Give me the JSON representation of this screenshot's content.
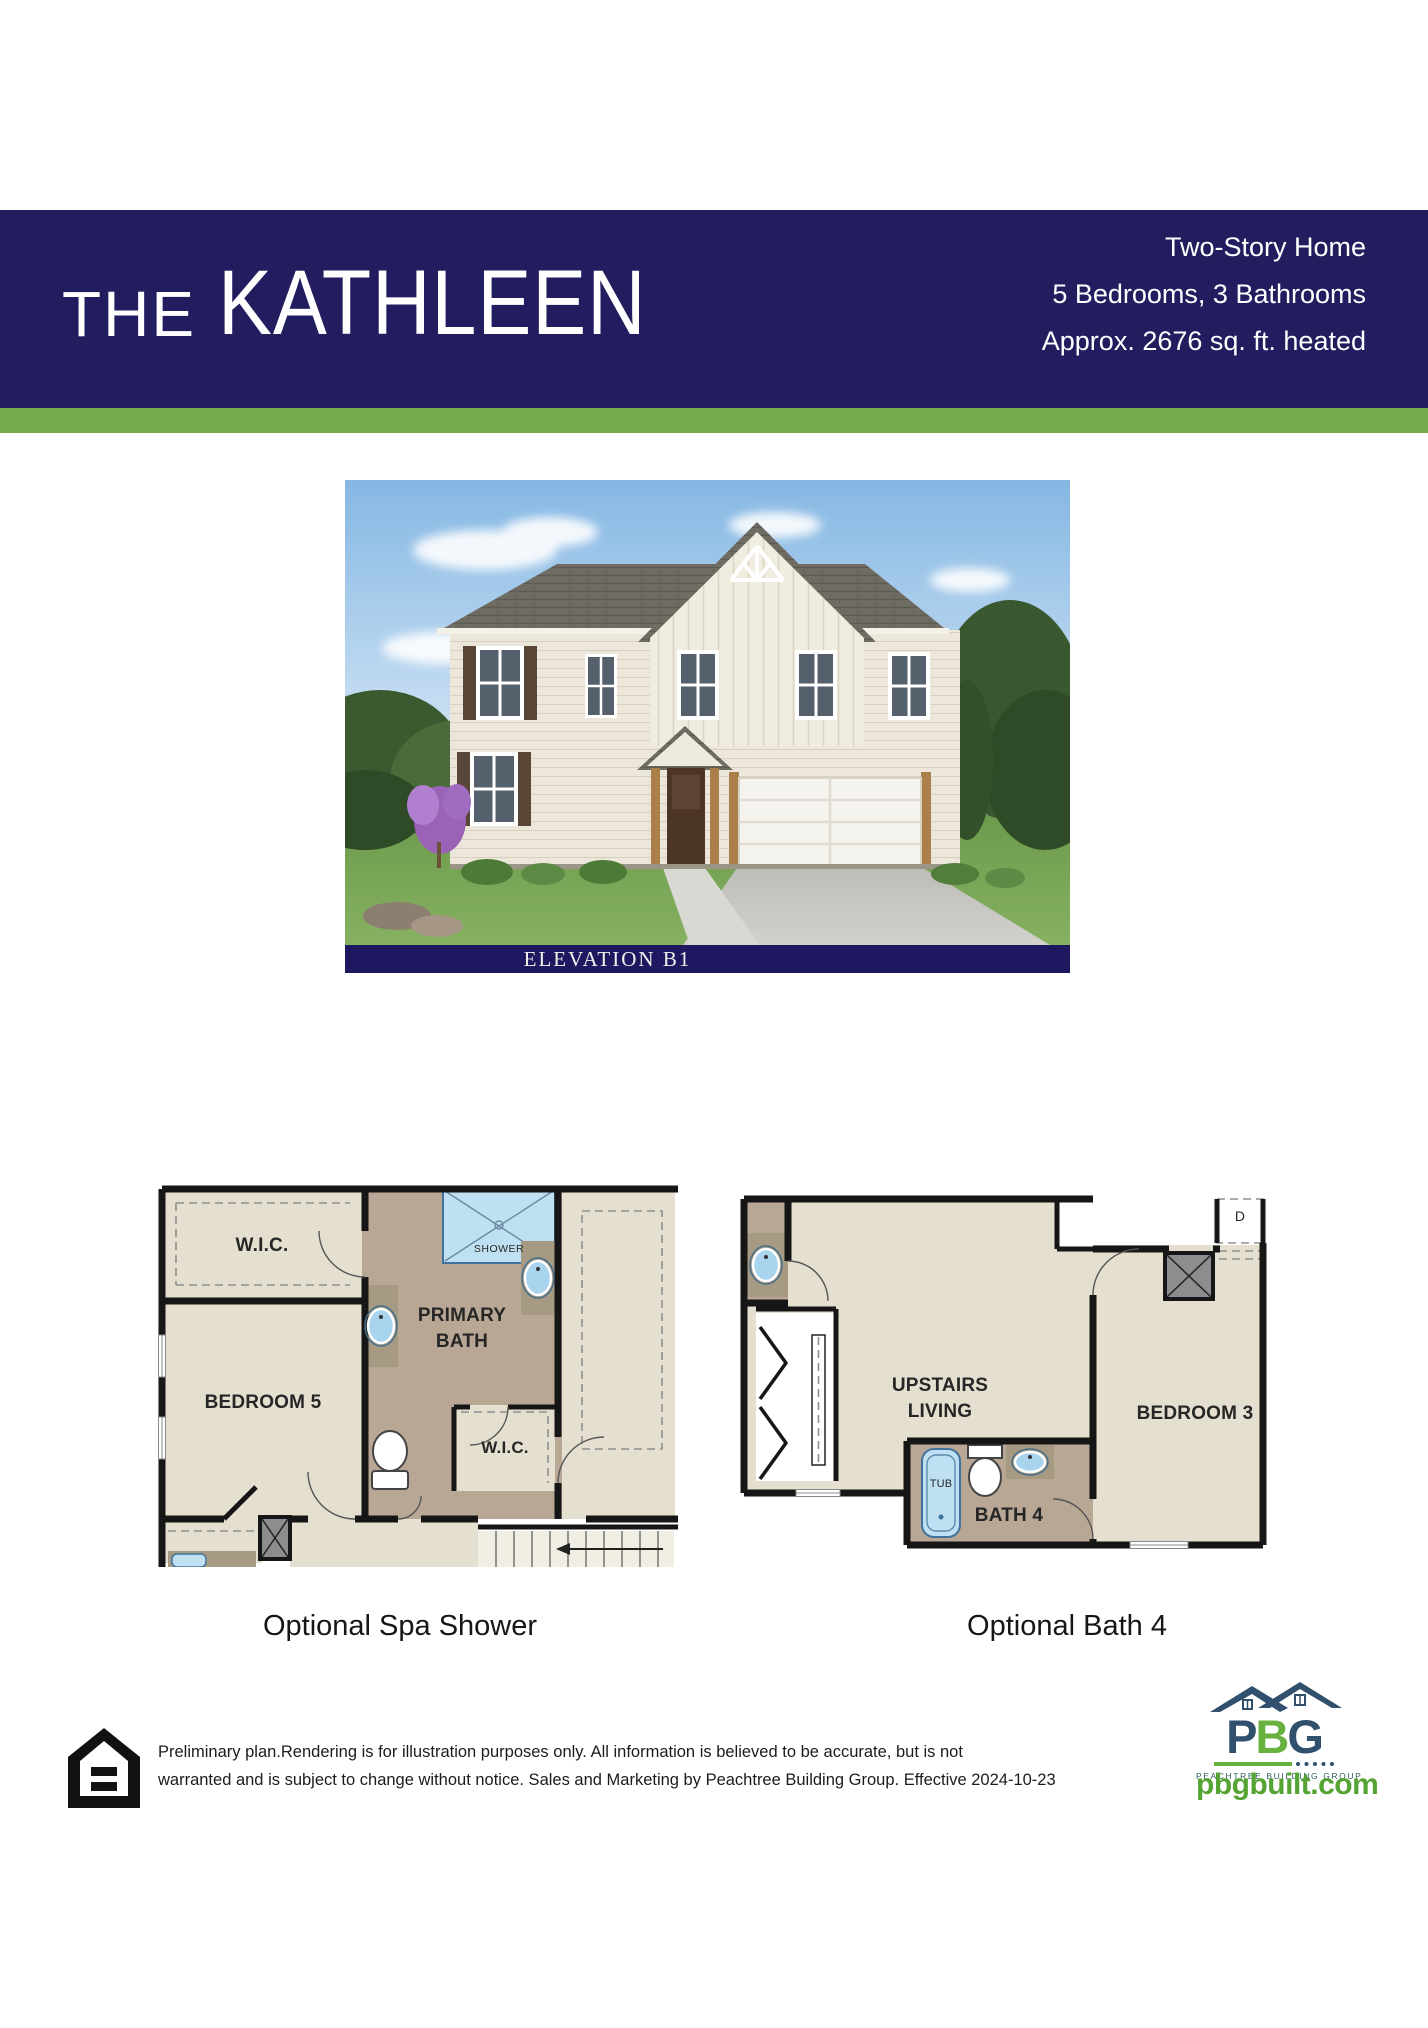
{
  "header": {
    "collection_label": "THE",
    "plan_name": "KATHLEEN",
    "stats": [
      "Two-Story Home",
      "5 Bedrooms, 3 Bathrooms",
      "Approx. 2676 sq. ft. heated"
    ]
  },
  "elevation": {
    "label": "ELEVATION B1"
  },
  "floorplans": {
    "left": {
      "caption": "Optional Spa Shower",
      "rooms": {
        "wic_top": "W.I.C.",
        "bedroom5": "BEDROOM 5",
        "primary_bath": "PRIMARY BATH",
        "shower": "SHOWER",
        "wic_bath": "W.I.C."
      }
    },
    "right": {
      "caption": "Optional Bath 4",
      "rooms": {
        "upstairs_living": "UPSTAIRS LIVING",
        "bedroom3": "BEDROOM 3",
        "bath4": "BATH 4",
        "tub": "TUB",
        "dryer": "D"
      }
    }
  },
  "footer": {
    "disclaimer_line1": "Preliminary plan.Rendering is for illustration purposes only. All information is believed to be accurate, but is not",
    "disclaimer_line2": "warranted and is subject to change without notice. Sales and Marketing by Peachtree Building Group. Effective 2024-10-23",
    "logo": {
      "letters": [
        "P",
        "B",
        "G"
      ],
      "tagline": "PEACHTREE BUILDING GROUP",
      "website": "pbgbuilt.com"
    },
    "icons": [
      "equal-housing-icon",
      "pbg-rooflines-icon"
    ]
  },
  "colors": {
    "navy": "#221d5f",
    "stripe-green": "#76a84d",
    "beige": "#e5dfcf",
    "taupe": "#b9a795",
    "counter": "#a69a83",
    "fixture-blue": "#bfe0f2",
    "gray-box": "#8d8d8d",
    "logo-navy": "#31506d",
    "logo-green": "#68b13e",
    "web-green": "#55a333"
  }
}
